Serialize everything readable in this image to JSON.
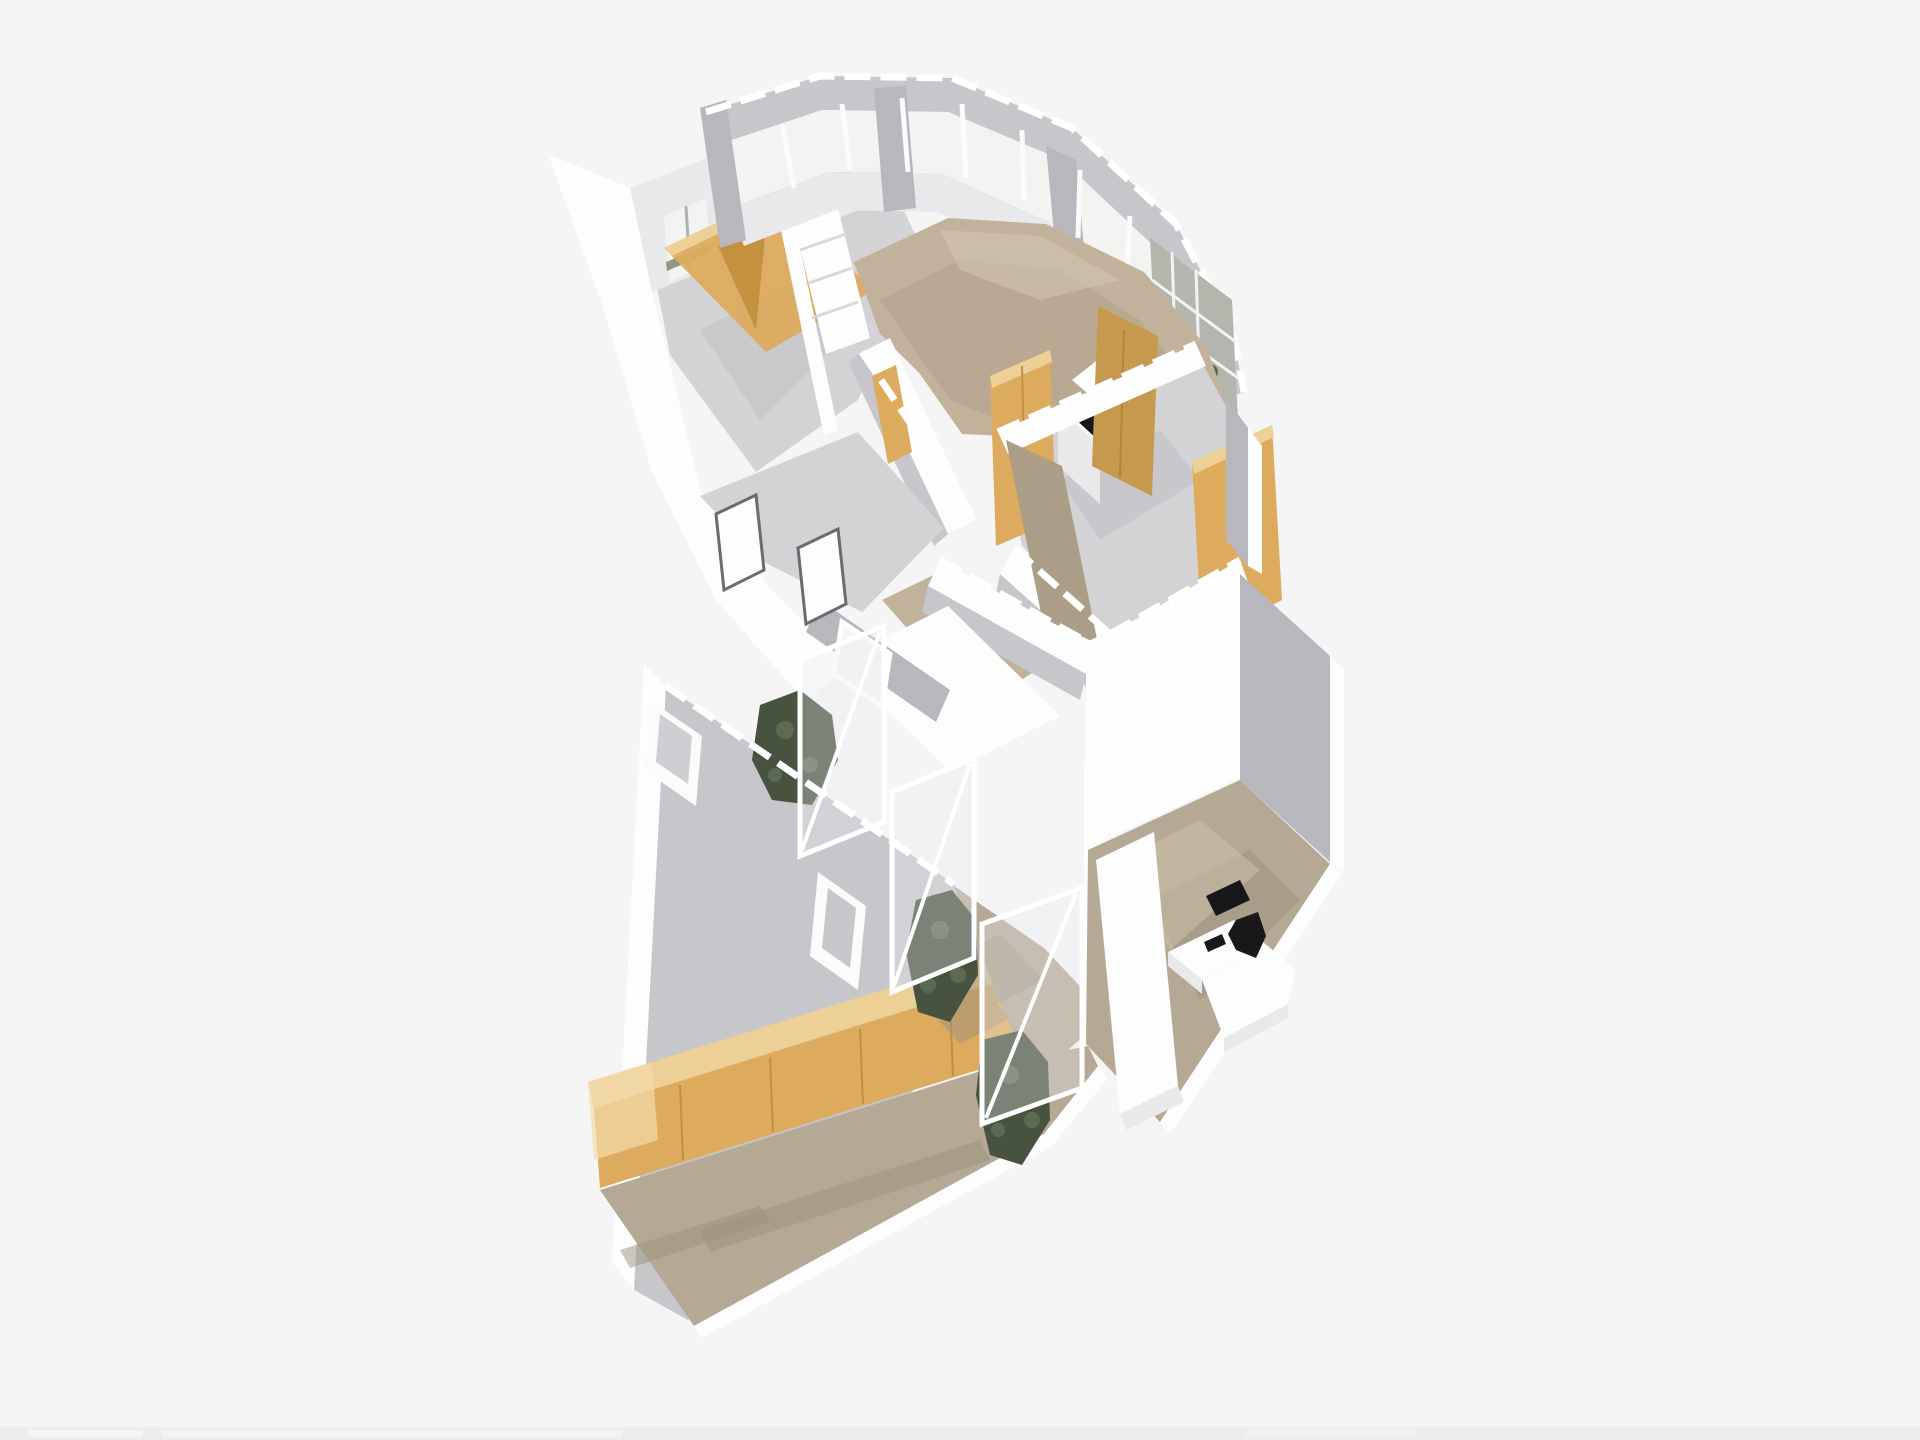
{
  "app": {
    "title": "3D floor plan view",
    "background": "#f5f5f6",
    "chrome_visible": false
  },
  "palette": {
    "bg": "#f5f5f6",
    "wallWhite": "#fdfdfe",
    "wallLight": "#e9e9ec",
    "wallMid": "#c6c6cb",
    "wallGray": "#b7b7bd",
    "floorGray": "#d3d3d6",
    "floorGrayDark": "#bdbdc2",
    "carpet": "#c3b29b",
    "carpetDark": "#ac9d87",
    "carpetLight": "#d2c4ae",
    "floorTan": "#b5a995",
    "floorTanDark": "#9c917e",
    "wood": "#dcab5e",
    "woodLight": "#edd096",
    "woodDark": "#c3913f",
    "woodDeep": "#c69a4e",
    "plant": "#5d6a52",
    "plantDark": "#47523f",
    "hedge": "#8b9a7e",
    "sky": "#f3f4f2",
    "black": "#18181b",
    "frame": "#ffffff",
    "edgeStrip": "#ededef"
  },
  "scene": {
    "type": "isometric-dollhouse-floorplan-render",
    "view": "top-down oblique, building rotated clockwise, walls cut at waist height",
    "sections": [
      {
        "id": "north-wing",
        "rooms": [
          {
            "id": "room-upper-left",
            "floor": "gray",
            "features": [
              "two windows in back wall",
              "angled wood wardrobe with dark opening",
              "white stair slab"
            ]
          },
          {
            "id": "open-area",
            "floor": "tan carpet",
            "features": [
              "curved perimeter window wall with greenery outside",
              "white kitchen island with black cooktop"
            ]
          },
          {
            "id": "rooms-right",
            "floor": "gray",
            "features": [
              "bright wood wardrobe",
              "dark wood wall",
              "wood panel wall",
              "grid window section with plants"
            ]
          }
        ]
      },
      {
        "id": "corridor",
        "floor": "tan carpet",
        "features": [
          "wood door on left wall",
          "white partition walls",
          "framed window over atrium"
        ]
      },
      {
        "id": "south-wing",
        "rooms": [
          {
            "id": "hall",
            "floor": "tan",
            "features": [
              "long wood cabinet row",
              "white framed window upper-left",
              "white framed window center",
              "white outer wall band"
            ]
          },
          {
            "id": "atrium",
            "features": [
              "three glass partition panes with white frames",
              "three dark green plant clusters"
            ]
          },
          {
            "id": "office",
            "floor": "tan",
            "features": [
              "bright white wall panel",
              "white L-shaped desk",
              "black monitor",
              "black office chair",
              "white leaning door slab"
            ]
          }
        ]
      }
    ],
    "furniture": [
      "wardrobe",
      "kitchen island with cooktop",
      "cabinet row",
      "L-shaped desk",
      "office chair",
      "monitor",
      "plants"
    ]
  },
  "edge_bar": {
    "description": "faint light strip at very bottom of screenshot",
    "segments": 3
  }
}
